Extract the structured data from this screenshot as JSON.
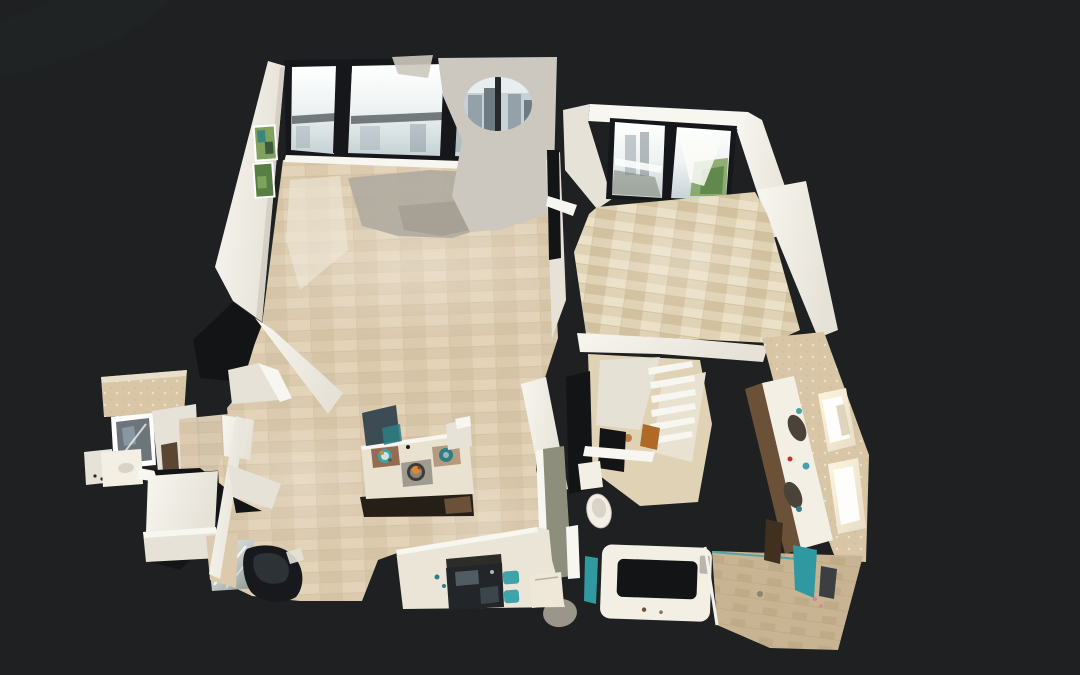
{
  "viewer": {
    "view_label": "3D dollhouse view",
    "description": "Top-down 3D dollhouse scan of an apartment shown on a dark background: living room with floor-to-ceiling city-view windows and green wall art, foyer with glass balcony doors, dining area, kitchen with island and black cooktop, walk-in closet, bathroom with double vanity, bathtub and glass shower, and a powder room. Unscanned regions appear as black holes."
  },
  "rooms": [
    {
      "id": "living-room",
      "label": "Living room with floor-to-ceiling city-view windows"
    },
    {
      "id": "foyer",
      "label": "Foyer with glass balcony doors"
    },
    {
      "id": "dining-area",
      "label": "Dining area"
    },
    {
      "id": "kitchen",
      "label": "Kitchen with island and cooktop"
    },
    {
      "id": "closet",
      "label": "Walk-in closet with shelving"
    },
    {
      "id": "bathroom",
      "label": "Bathroom with double vanity, bathtub and shower"
    },
    {
      "id": "powder-room",
      "label": "Powder room with mirror and vanity"
    }
  ],
  "features": [
    {
      "id": "window-wall",
      "label": "Window wall with balcony rail and city skyline"
    },
    {
      "id": "wall-art",
      "label": "Two green artworks on the living room wall"
    },
    {
      "id": "kitchen-island",
      "label": "Kitchen island with two teal place settings"
    },
    {
      "id": "cooktop",
      "label": "Black glass cooktop with teal trivets"
    },
    {
      "id": "bathtub",
      "label": "White bathtub with unscanned dark interior"
    },
    {
      "id": "shower",
      "label": "Glass shower with teal towel"
    },
    {
      "id": "double-vanity",
      "label": "Double vanity with two dark sinks and lit mirrors"
    },
    {
      "id": "toilet",
      "label": "Toilet"
    },
    {
      "id": "armchair",
      "label": "Black leather armchair"
    },
    {
      "id": "scan-holes",
      "label": "Unscanned black gaps in the 3D mesh"
    }
  ],
  "palette": {
    "bg": "#1e2021",
    "hole": "#131416",
    "wall-bright": "#f8f6f0",
    "wall-mid": "#e6e2d8",
    "wall-shade": "#cdc8bc",
    "wall-gray": "#ccc8bf",
    "floor-a": "#dbcaae",
    "floor-b": "#e6d9bf",
    "floor-c": "#cebb9c",
    "floor-worn": "#efe8d8",
    "floor-gray": "#b2ada1",
    "foyer-a": "#e0d2b5",
    "foyer-b": "#eee3cb",
    "foyer-c": "#ccb996",
    "shower-a": "#c8b493",
    "shower-b": "#baa582",
    "glass-mid": "#eef2f2",
    "glass-bottom": "#c6d2d5",
    "city": "#95a1a9",
    "city-dark": "#6f7b83",
    "rail": "#4c5356",
    "green": "#7fa25f",
    "green-dark": "#587f43",
    "teal": "#3fa4a9",
    "teal-dark": "#2e7e85",
    "towel-teal": "#2f98a0",
    "wood": "#6b5138",
    "wood-dark": "#41301f",
    "island-top": "#eae2d1",
    "island-base": "#261f18",
    "chair-slate": "#3c4b54",
    "leather-black": "#17191c",
    "leather-hi": "#33383d",
    "mirror-silver": "#c8cecb",
    "mirror-dark": "#879090",
    "counter-white": "#ebe5d8",
    "cooktop": "#22262a",
    "cabinet-olive": "#8e8e7c",
    "vanity-counter": "#f4efe5",
    "sink-dark": "#4b423a",
    "light-glow": "#fdf5dc",
    "tile-wall": "#d9c6a7",
    "accent-red": "#c23327",
    "accent-orange": "#de8a2e",
    "accent-pink": "#d8849a",
    "mat-brown": "#8a5f42",
    "mat-tan": "#b59b7e"
  }
}
